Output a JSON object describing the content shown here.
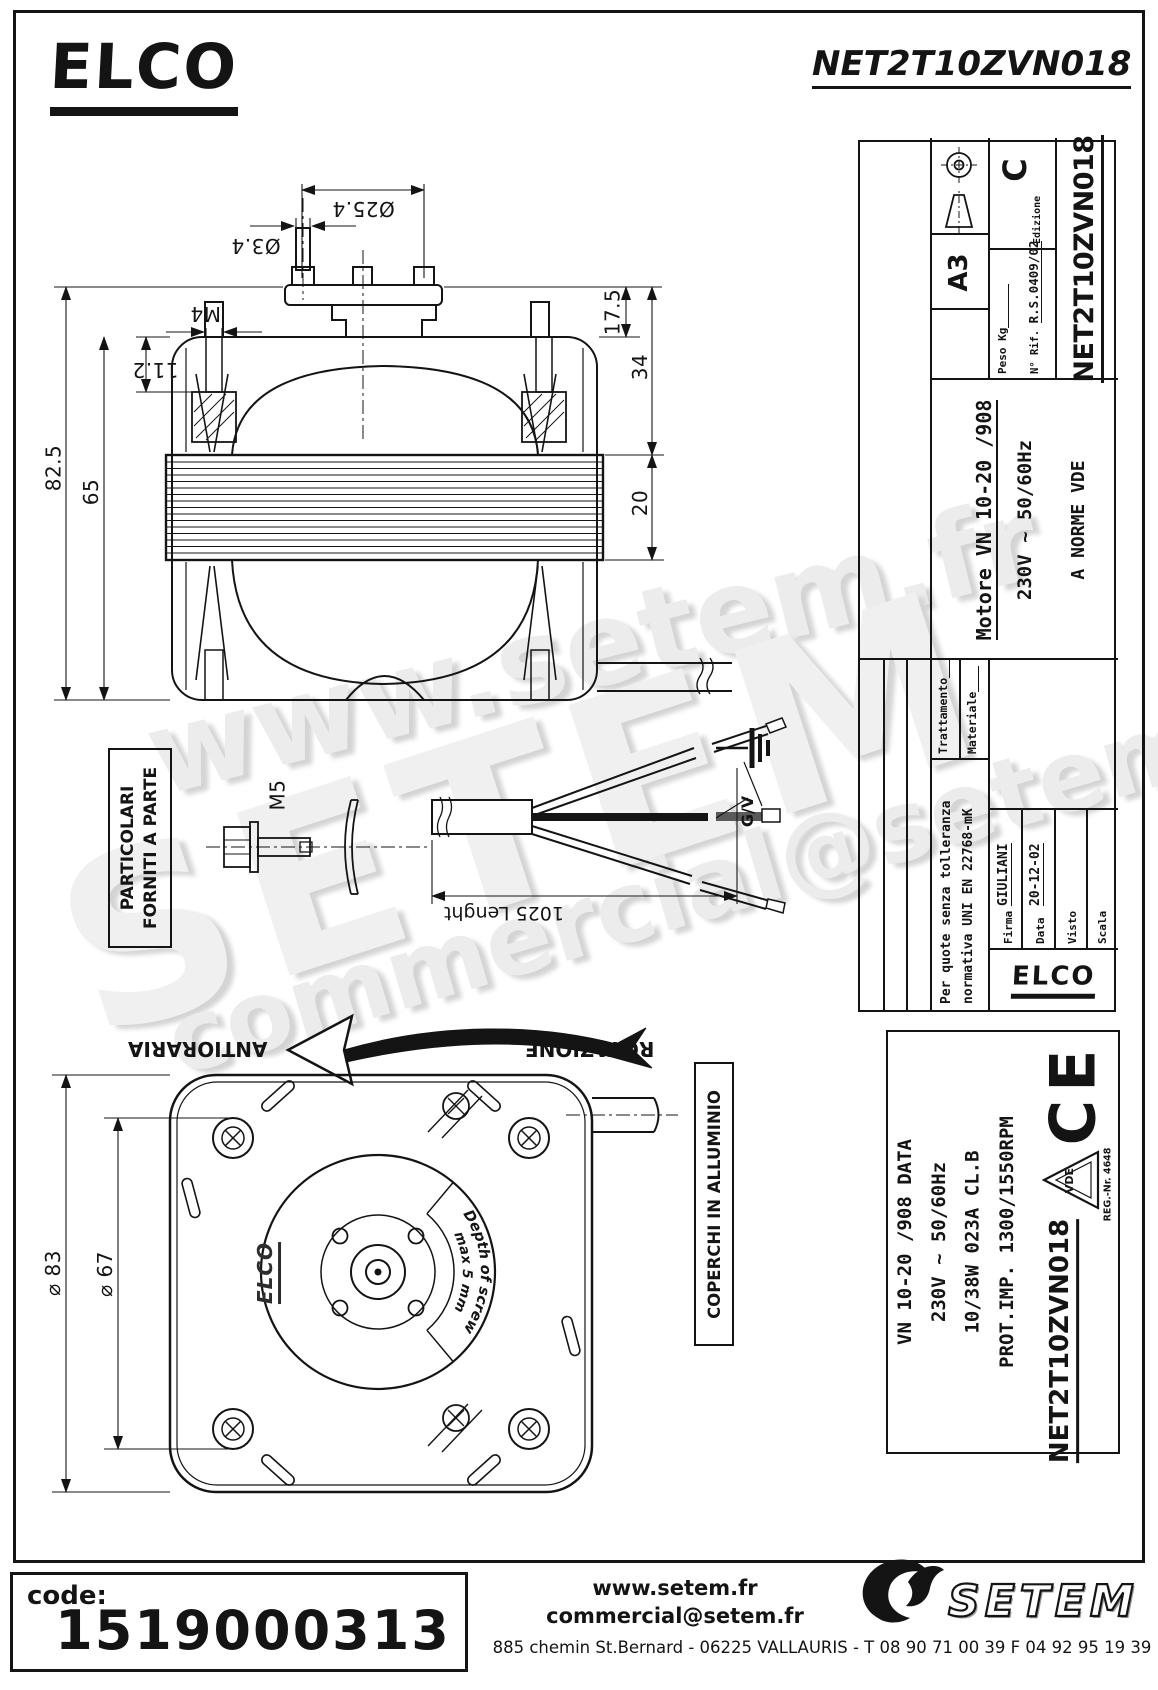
{
  "header": {
    "brand_logo": "ELCO",
    "drawing_title": "NET2T10ZVN018"
  },
  "top_view": {
    "dim_flange_dia": "Ø25.4",
    "dim_pin_dia": "Ø3.4",
    "dim_stud_thread": "M4",
    "dim_17_5": "17.5",
    "dim_34": "34",
    "dim_11_2": "11.2",
    "dim_82_5": "82.5",
    "dim_65": "65",
    "dim_20": "20"
  },
  "parts_note": {
    "line1": "PARTICOLARI",
    "line2": "FORNITI A PARTE",
    "screw_label": "M5"
  },
  "cable_view": {
    "length_dim": "1025 Lenght",
    "ground_wire_label": "G/V"
  },
  "rotation_note": {
    "direction": "ANTIORARIA",
    "label": "ROTAZIONE"
  },
  "bottom_view": {
    "dim_dia_83": "⌀ 83",
    "dim_dia_67": "⌀ 67",
    "cast_logo": "ELCO",
    "screw_depth_arc_line1": "Depth of screw",
    "screw_depth_arc_line2": "max 5 mm",
    "cover_note": "COPERCHI IN ALLUMINIO"
  },
  "spec_block": {
    "line1": "VN 10-20  /908  DATA",
    "line2": "230V ~ 50/60Hz",
    "line3": "10/38W 023A CL.B",
    "line4": "PROT.IMP. 1300/1550RPM",
    "ce_mark": "CE",
    "vde_mark": "VDE",
    "vde_reg": "REG.-Nr. 4648",
    "part_number": "NET2T10ZVN018"
  },
  "title_block": {
    "tolerance_line1": "Per quote senza tolleranza",
    "tolerance_line2": "normativa UNI EN 22768-mK",
    "treatment_label": "Trattamento",
    "material_label": "Materiale",
    "firma_label": "Firma",
    "firma_value": "GIULIANI",
    "data_label": "Data",
    "data_value": "20-12-02",
    "visto_label": "Visto",
    "scala_label": "Scala",
    "product_line1": "Motore VN 10-20  /908",
    "product_line2": "230V ~ 50/60Hz",
    "product_line3": "A NORME VDE",
    "peso_label": "Peso Kg",
    "rif_label": "N° Rif.",
    "rif_value": "R.S.0409/02",
    "edition_label": "Edizione",
    "edition_value": "C",
    "sheet_format": "A3",
    "part_number": "NET2T10ZVN018",
    "logo": "ELCO"
  },
  "footer": {
    "code_label": "code:",
    "code_value": "1519000313",
    "website": "www.setem.fr",
    "email": "commercial@setem.fr",
    "address": "885 chemin St.Bernard  -  06225 VALLAURIS  -  T 08 90 71 00 39   F 04 92 95 19 39",
    "brand": "SETEM"
  },
  "watermarks": {
    "wm1": "www.setem.fr",
    "wm2": "SETEM",
    "wm3": "commercial@setem.fr"
  }
}
